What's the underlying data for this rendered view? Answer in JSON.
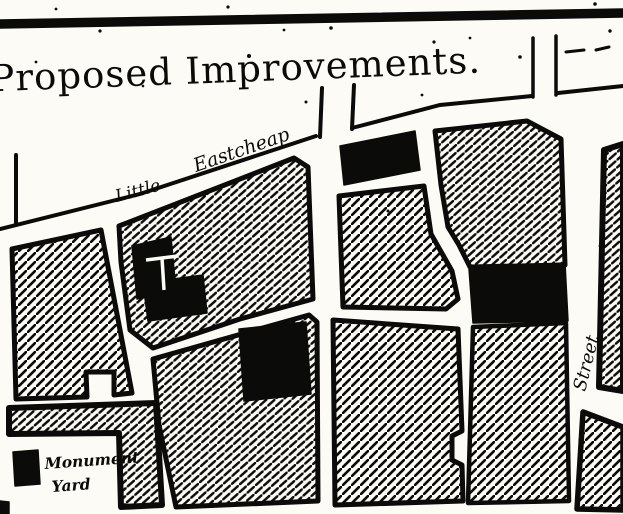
{
  "title": "Proposed Improvements.",
  "map_labels": {
    "little": "Little",
    "eastcheap": "Eastcheap",
    "street": "Street"
  },
  "legend": {
    "line1": "Monument",
    "line2": "Yard",
    "marker_icon": "monument-square"
  },
  "colors": {
    "ink": "#0b0b09",
    "paper": "#fcfbf6"
  }
}
